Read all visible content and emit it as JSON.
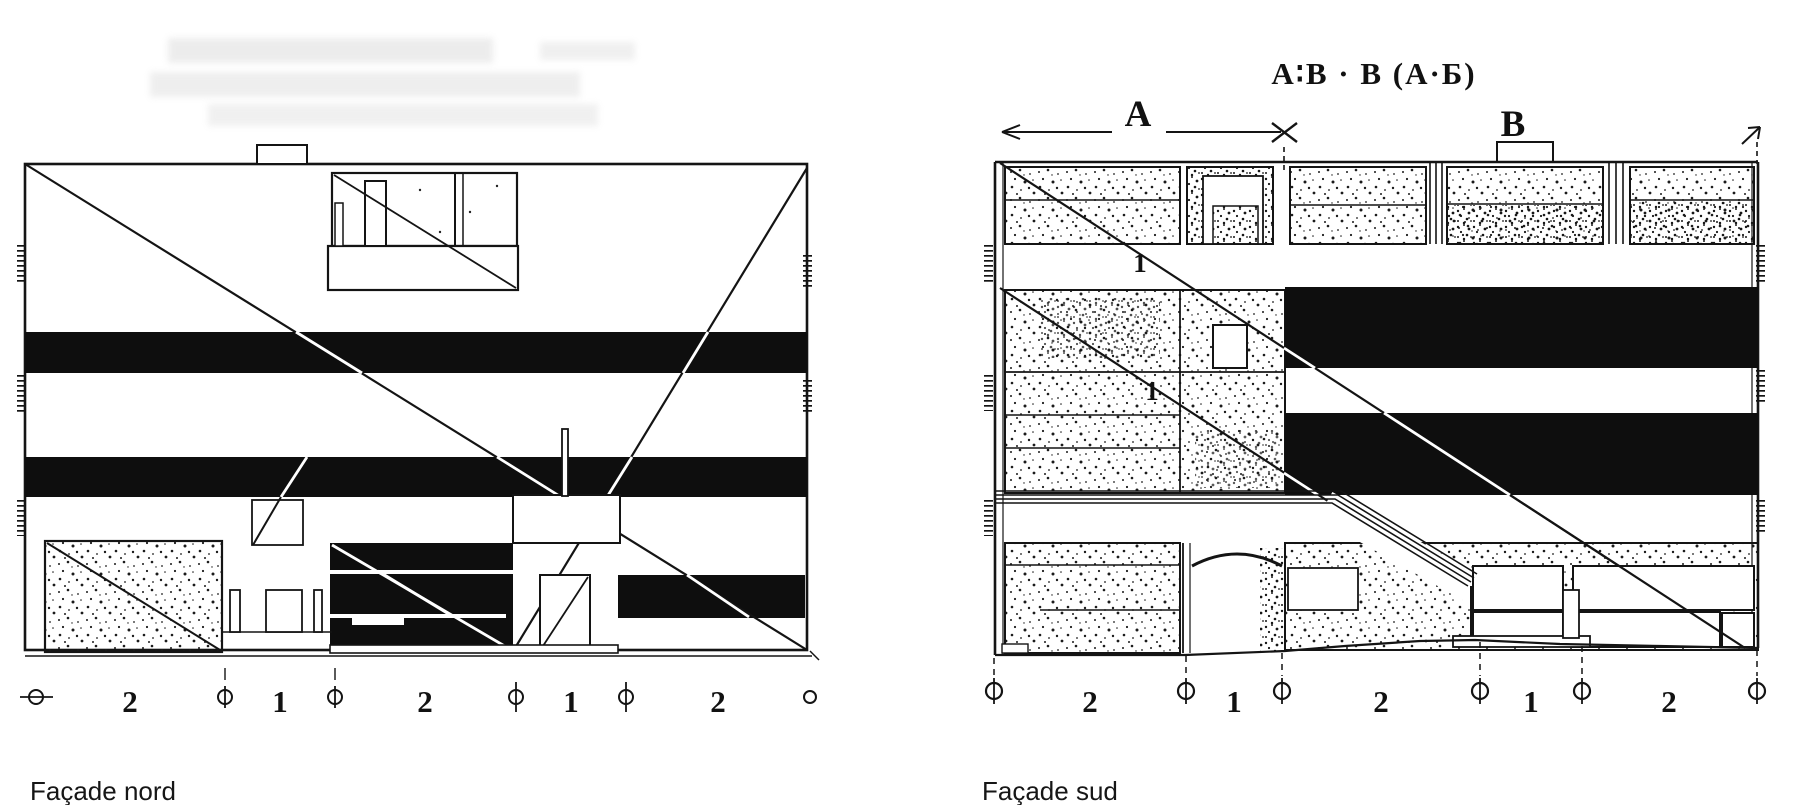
{
  "figure": {
    "formula": "A∶B · B (A·Б)",
    "left_facade": {
      "caption": "Façade nord",
      "dimension_labels": [
        "2",
        "1",
        "2",
        "1",
        "2"
      ]
    },
    "right_facade": {
      "caption": "Façade sud",
      "dimension_labels": [
        "2",
        "1",
        "2",
        "1",
        "2"
      ],
      "span_a_label": "A",
      "span_b_label": "B",
      "diagonal_labels": [
        "1",
        "1"
      ]
    }
  }
}
